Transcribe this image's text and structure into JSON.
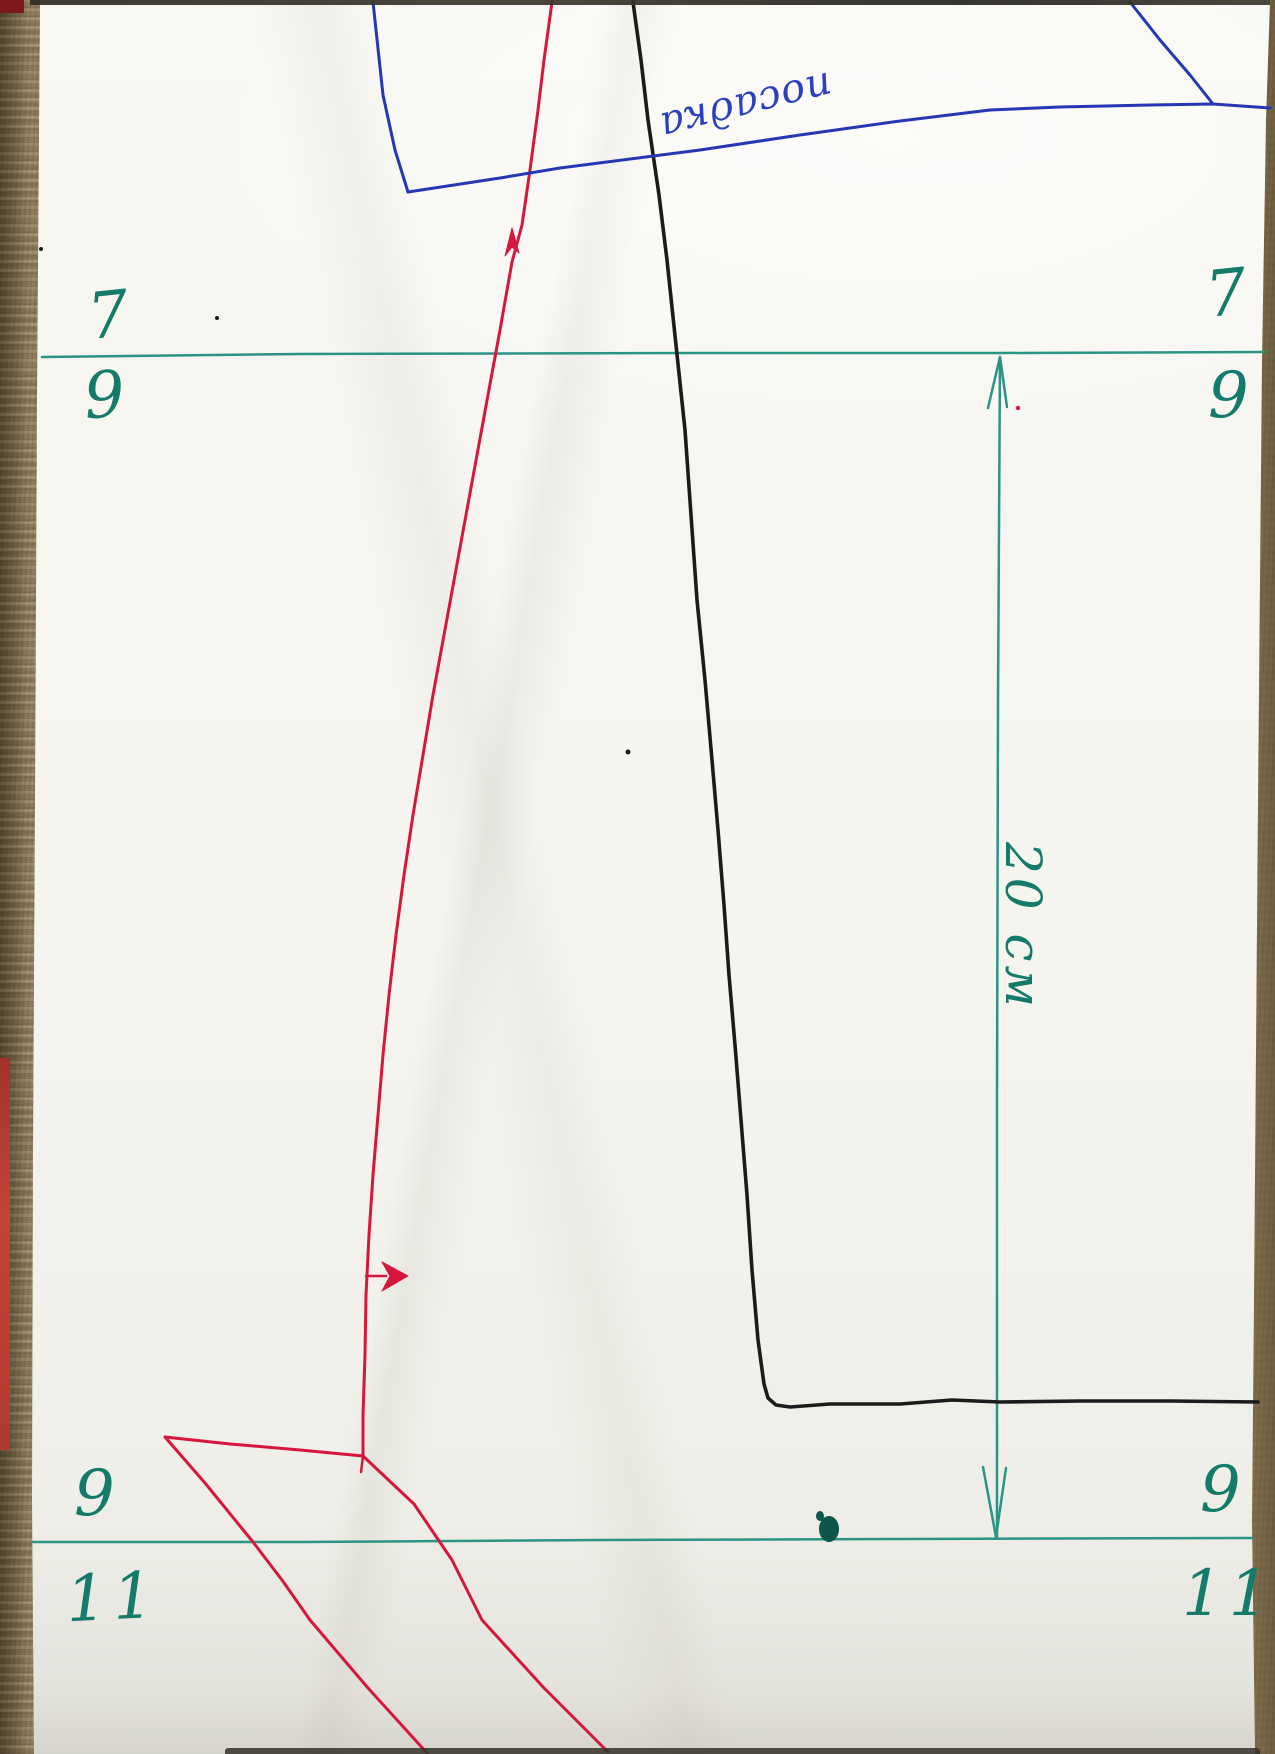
{
  "labels": {
    "top_left_upper": "7",
    "top_left_lower": "9",
    "top_right_upper": "7",
    "top_right_lower": "9",
    "bottom_left_upper": "9",
    "bottom_left_lower": "11",
    "bottom_right_upper": "9",
    "bottom_right_lower": "11",
    "dimension": "20 см",
    "annotation": "посадка"
  },
  "colors": {
    "teal_line": "#2a9485",
    "teal_text": "#147a69",
    "teal_dark": "#0c564c",
    "blue": "#2437b4",
    "blue_text": "#2c40bf",
    "red": "#d6173c",
    "black": "#1b1b1b"
  },
  "drawing": {
    "paths": [
      {
        "name": "green-top-guide-line",
        "color": "teal_line",
        "width": 2.5,
        "points": "42,357 300,354 700,353 1000,353 1264,352"
      },
      {
        "name": "green-bottom-guide-line",
        "color": "teal_line",
        "width": 2.5,
        "points": "33,1542 300,1542 600,1540 900,1539 1252,1538"
      },
      {
        "name": "green-dimension-line",
        "color": "teal_line",
        "width": 2.5,
        "points": "1000,357 998,700 997,1100 997,1537"
      },
      {
        "name": "green-dimension-arrowhead-top",
        "color": "teal_line",
        "width": 2.5,
        "points": "988,408 1000,357 1007,407"
      },
      {
        "name": "green-dimension-arrowhead-bottom",
        "color": "teal_line",
        "width": 2.5,
        "points": "983,1467 996,1537 1006,1468"
      },
      {
        "name": "black-seam-line",
        "color": "black",
        "width": 3.6,
        "points": "633,2 641,60 648,120 659,195 667,260 676,345 685,430 691,515 697,600 705,680 712,760 718,830 724,905 729,975 735,1045 741,1120 747,1195 752,1270 758,1340 764,1384 768,1398 776,1405 790,1407 830,1404 900,1404 952,1400 1000,1402 1080,1401 1170,1401 1258,1402"
      },
      {
        "name": "red-side-seam-line",
        "color": "red",
        "width": 3,
        "points": "552,2 544,60 538,110 530,170 522,225 512,262 500,330 488,395 477,455 466,515 455,575 444,635 433,695 423,755 413,815 404,875 396,935 389,995 383,1055 378,1115 373,1175 369,1235 366,1295 365,1355 363,1415 363,1456"
      },
      {
        "name": "red-flap-top-edge",
        "color": "red",
        "width": 3,
        "points": "165,1437 230,1444 300,1450 363,1456"
      },
      {
        "name": "red-junction-tick",
        "color": "red",
        "width": 2.5,
        "points": "363,1456 361,1472"
      },
      {
        "name": "red-flap-left-edge",
        "color": "red",
        "width": 3,
        "points": "165,1437 205,1483 253,1542 282,1580 310,1620 368,1688 427,1753"
      },
      {
        "name": "red-flap-right-edge",
        "color": "red",
        "width": 3,
        "points": "363,1456 414,1504 452,1560 482,1620 544,1688 608,1752"
      },
      {
        "name": "red-grainline-arrow-tail",
        "color": "red",
        "width": 2.5,
        "points": "366,1276 386,1276"
      },
      {
        "name": "blue-left-line",
        "color": "blue",
        "width": 3,
        "points": "373,2 383,95 395,150 408,192"
      },
      {
        "name": "blue-long-line",
        "color": "blue",
        "width": 3,
        "points": "408,192 500,178 560,168 700,150 800,135 900,121 990,110 1060,107 1150,105 1213,104 1270,108"
      },
      {
        "name": "blue-diagonal-line",
        "color": "blue",
        "width": 3,
        "points": "1130,2 1160,40 1190,75 1213,104"
      }
    ],
    "polygons": [
      {
        "name": "red-grainline-arrowhead",
        "color": "red",
        "points": "382,1262 408,1276 382,1291 390,1276"
      },
      {
        "name": "red-upper-arrow-tick",
        "color": "red",
        "points": "505,256 512,228 519,253 512,247"
      }
    ],
    "ellipses": [
      {
        "name": "ink-blot",
        "color": "teal_dark",
        "cx": 829,
        "cy": 1529,
        "rx": 10,
        "ry": 13
      },
      {
        "name": "ink-blot-small",
        "color": "teal_dark",
        "cx": 820,
        "cy": 1516,
        "rx": 4,
        "ry": 5
      }
    ],
    "dots": [
      {
        "name": "black-speck-mid",
        "color": "black",
        "cx": 628,
        "cy": 752,
        "r": 2.5
      },
      {
        "name": "black-speck-top",
        "color": "black",
        "cx": 217,
        "cy": 318,
        "r": 2
      },
      {
        "name": "black-speck-left",
        "color": "black",
        "cx": 41,
        "cy": 249,
        "r": 2
      },
      {
        "name": "red-speck",
        "color": "red",
        "cx": 1018,
        "cy": 408,
        "r": 2.2
      }
    ]
  }
}
